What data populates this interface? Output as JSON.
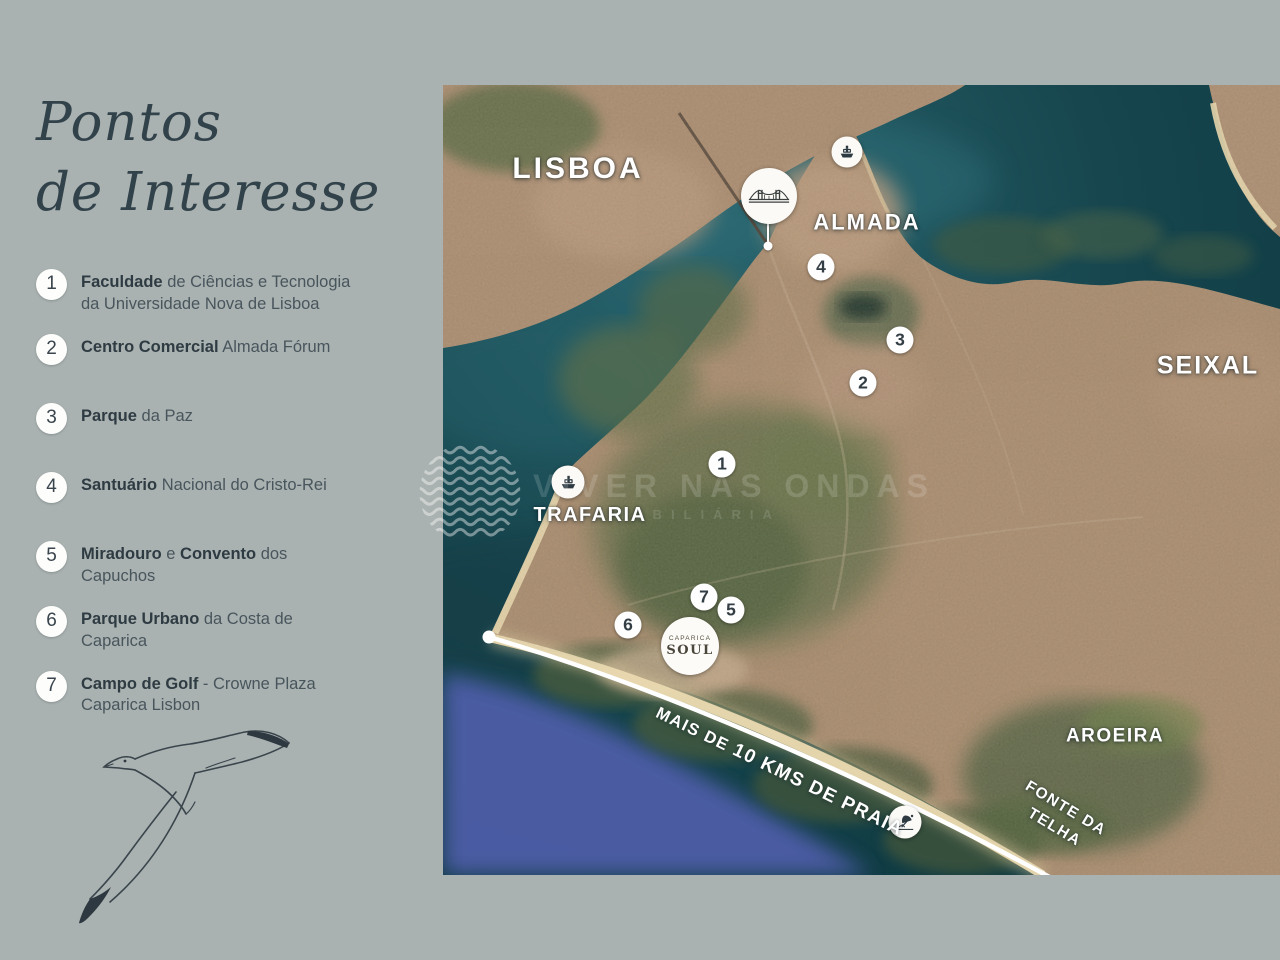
{
  "page": {
    "background": "#a9b2b0"
  },
  "sidebar": {
    "title_line1": "Pontos",
    "title_line2": "de Interesse",
    "items": [
      {
        "number": "1",
        "two_line": true,
        "segments": [
          {
            "t": "Faculdade",
            "b": true
          },
          {
            "t": " de Ciências e Tecnologia\nda Universidade Nova de Lisboa",
            "b": false
          }
        ]
      },
      {
        "number": "2",
        "two_line": false,
        "segments": [
          {
            "t": "Centro Comercial",
            "b": true
          },
          {
            "t": " Almada Fórum",
            "b": false
          }
        ]
      },
      {
        "number": "3",
        "two_line": false,
        "segments": [
          {
            "t": "Parque",
            "b": true
          },
          {
            "t": " da Paz",
            "b": false
          }
        ]
      },
      {
        "number": "4",
        "two_line": false,
        "segments": [
          {
            "t": "Santuário",
            "b": true
          },
          {
            "t": " Nacional do Cristo-Rei",
            "b": false
          }
        ]
      },
      {
        "number": "5",
        "two_line": true,
        "segments": [
          {
            "t": "Miradouro",
            "b": true
          },
          {
            "t": " e ",
            "b": false
          },
          {
            "t": "Convento",
            "b": true
          },
          {
            "t": " dos\nCapuchos",
            "b": false
          }
        ]
      },
      {
        "number": "6",
        "two_line": true,
        "segments": [
          {
            "t": "Parque Urbano",
            "b": true
          },
          {
            "t": " da Costa de\nCaparica",
            "b": false
          }
        ]
      },
      {
        "number": "7",
        "two_line": true,
        "segments": [
          {
            "t": "Campo de Golf",
            "b": true
          },
          {
            "t": " - Crowne Plaza\nCaparica Lisbon",
            "b": false
          }
        ]
      }
    ]
  },
  "map": {
    "labels": [
      {
        "id": "lisboa",
        "text": "LISBOA",
        "x": 135,
        "y": 84,
        "size": 30,
        "ls": 3,
        "rot": 0
      },
      {
        "id": "almada",
        "text": "ALMADA",
        "x": 424,
        "y": 138,
        "size": 22,
        "ls": 2,
        "rot": 0
      },
      {
        "id": "seixal",
        "text": "SEIXAL",
        "x": 765,
        "y": 281,
        "size": 25,
        "ls": 2,
        "rot": 0
      },
      {
        "id": "trafaria",
        "text": "TRAFARIA",
        "x": 147,
        "y": 430,
        "size": 20,
        "ls": 1.5,
        "rot": 0
      },
      {
        "id": "aroeira",
        "text": "AROEIRA",
        "x": 672,
        "y": 652,
        "size": 19,
        "ls": 1.5,
        "rot": 0
      },
      {
        "id": "fonte-da-telha",
        "text": "FONTE DA\nTELHA",
        "x": 617,
        "y": 733,
        "size": 15.5,
        "ls": 1.5,
        "rot": 31
      }
    ],
    "markers": [
      {
        "n": "4",
        "x": 378,
        "y": 182
      },
      {
        "n": "3",
        "x": 457,
        "y": 255
      },
      {
        "n": "2",
        "x": 420,
        "y": 298
      },
      {
        "n": "1",
        "x": 279,
        "y": 379
      },
      {
        "n": "7",
        "x": 261,
        "y": 512
      },
      {
        "n": "5",
        "x": 288,
        "y": 525
      },
      {
        "n": "6",
        "x": 185,
        "y": 540
      }
    ],
    "coast_label": {
      "regular": "MAIS DE ",
      "bold": "10 KMS DE PRAIA"
    },
    "soul_logo": {
      "line1": "CAPARICA",
      "line2": "SOUL"
    },
    "watermark": {
      "brand": "VIVER NAS ONDAS",
      "sub": "IMOBILIÁRIA"
    },
    "icon_names": [
      "ferry-icon",
      "bridge-icon",
      "ferry-icon",
      "beach-icon"
    ]
  },
  "colors": {
    "panel_bg": "#a9b2b0",
    "title": "#32424b",
    "water": "#16454d",
    "deep_ocean": "#4d5da7",
    "land": "#ab8d72",
    "beach": "#ead9b0",
    "label": "#ffffff"
  }
}
